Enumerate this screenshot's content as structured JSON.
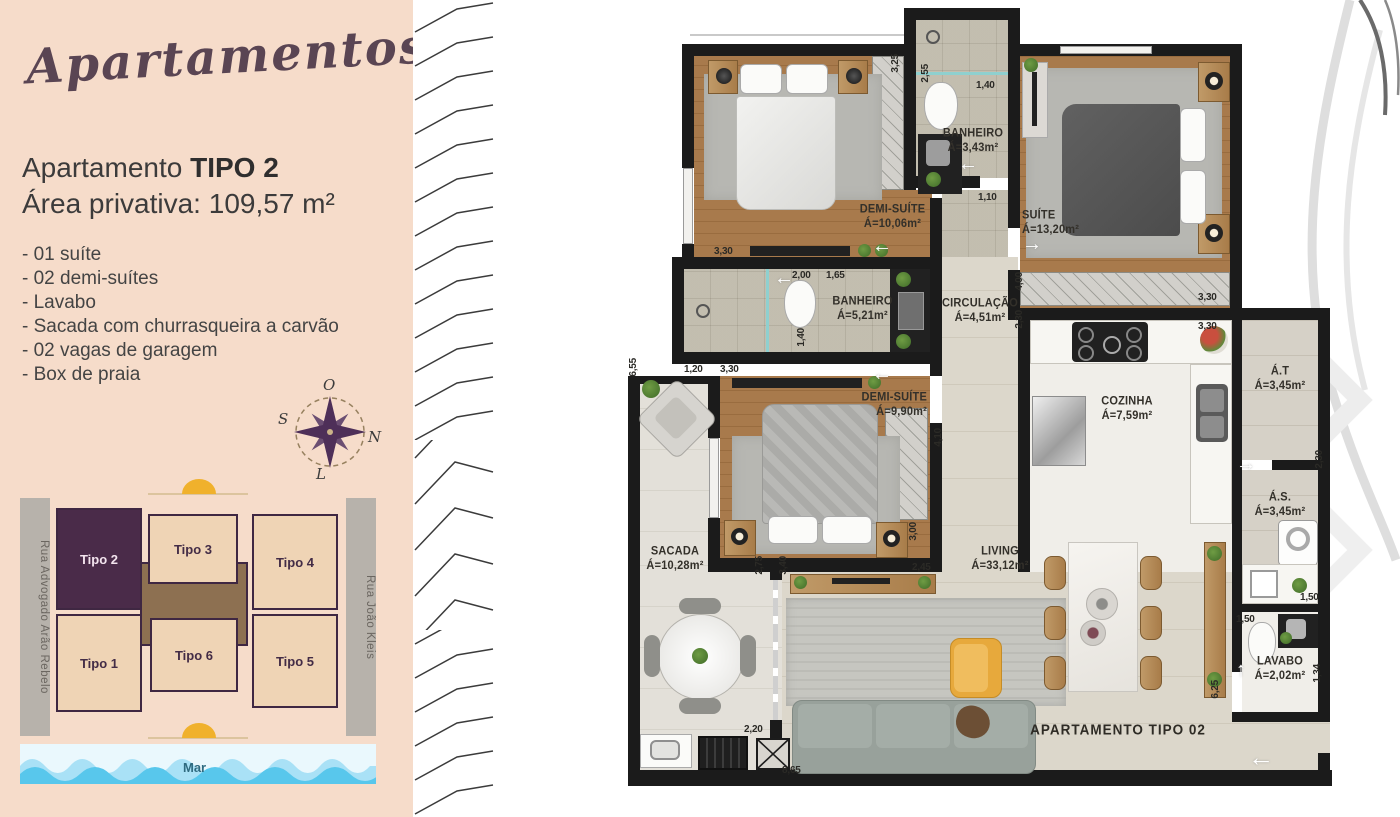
{
  "panel": {
    "logo": "Apartamentos",
    "title": {
      "regular": "Apartamento ",
      "bold": "TIPO 2"
    },
    "subtitle": "Área privativa: 109,57 m²",
    "features": [
      "- 01 suíte",
      "- 02 demi-suítes",
      "- Lavabo",
      "- Sacada com churrasqueira a carvão",
      "- 02 vagas de garagem",
      "- Box de praia"
    ],
    "compass": {
      "o": "O",
      "n": "N",
      "s": "S",
      "l": "L"
    },
    "siteplan": {
      "street_left": "Rua Advogado Arão Rebelo",
      "street_right": "Rua João Kleis",
      "buildings": [
        {
          "label": "Tipo 2",
          "highlight": true
        },
        {
          "label": "Tipo 3",
          "highlight": false
        },
        {
          "label": "Tipo 4",
          "highlight": false
        },
        {
          "label": "Tipo 1",
          "highlight": false
        },
        {
          "label": "Tipo 6",
          "highlight": false
        },
        {
          "label": "Tipo 5",
          "highlight": false
        }
      ],
      "sea": "Mar"
    }
  },
  "plan": {
    "apartment_label": "APARTAMENTO TIPO 02",
    "rooms": [
      {
        "name": "BANHEIRO",
        "area": "Á=3,43m²"
      },
      {
        "name": "DEMI-SUÍTE",
        "area": "Á=10,06m²"
      },
      {
        "name": "SUÍTE",
        "area": "Á=13,20m²"
      },
      {
        "name": "BANHEIRO",
        "area": "Á=5,21m²"
      },
      {
        "name": "CIRCULAÇÃO",
        "area": "Á=4,51m²"
      },
      {
        "name": "DEMI-SUÍTE",
        "area": "Á=9,90m²"
      },
      {
        "name": "COZINHA",
        "area": "Á=7,59m²"
      },
      {
        "name": "Á.T",
        "area": "Á=3,45m²"
      },
      {
        "name": "Á.S.",
        "area": "Á=3,45m²"
      },
      {
        "name": "SACADA",
        "area": "Á=10,28m²"
      },
      {
        "name": "LIVING",
        "area": "Á=33,12m²"
      },
      {
        "name": "LAVABO",
        "area": "Á=2,02m²"
      }
    ],
    "dims": [
      "2,55",
      "3,25",
      "1,40",
      "1,10",
      "3,30",
      "2,00",
      "1,65",
      "1,40",
      "1,20",
      "3,30",
      "4,10",
      "4,00",
      "2,30",
      "3,30",
      "3,30",
      "2,30",
      "1,50",
      "2,75",
      "3,40",
      "2,45",
      "3,00",
      "2,20",
      "8,65",
      "6,25",
      "1,50",
      "1,34",
      "6,55"
    ]
  },
  "colors": {
    "panel_beige": "#f6dcca",
    "accent_purple": "#4a2b49",
    "wall_black": "#1b1b1b",
    "wave_blue": "#58c7ec",
    "sun_yellow": "#f0b12c"
  }
}
